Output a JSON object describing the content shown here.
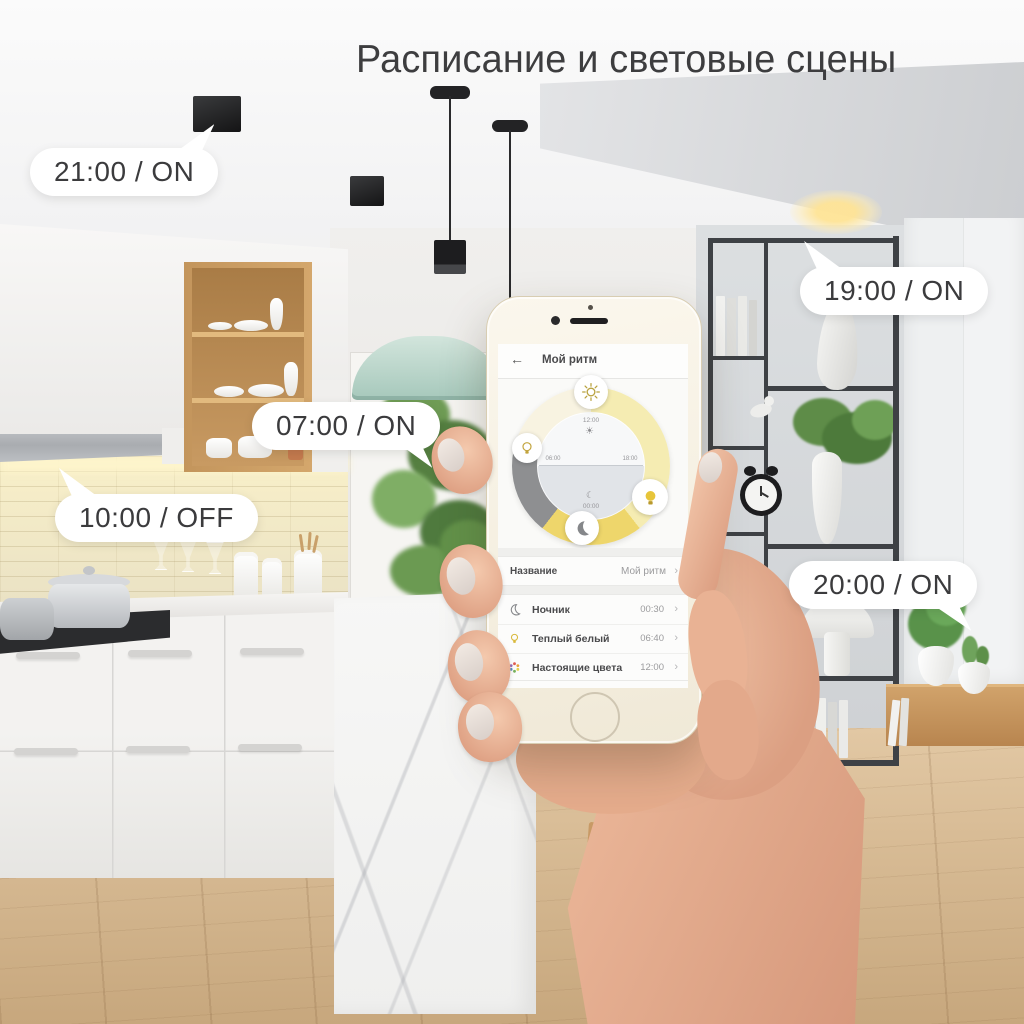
{
  "title": "Расписание и световые сцены",
  "callouts": {
    "c2100": "21:00 / ON",
    "c0700": "07:00 / ON",
    "c1000": "10:00 / OFF",
    "c1900": "19:00 / ON",
    "c2000": "20:00 / ON"
  },
  "phone": {
    "app": {
      "header": {
        "back": "←",
        "title": "Мой ритм"
      },
      "dial": {
        "top_time": "12:00",
        "left_time": "06:00",
        "right_time": "18:00",
        "bottom_time": "00:00",
        "sun_glyph": "☀",
        "moon_glyph": "☾",
        "segments": {
          "day": "#f5ecb2",
          "evening": "#eed66b",
          "night": "#8e8f91",
          "morning": "#f8f3e1"
        }
      },
      "name_row": {
        "label": "Название",
        "value": "Мой ритм",
        "chevron": "›"
      },
      "scenes": [
        {
          "icon": "moon-icon",
          "label": "Ночник",
          "time": "00:30",
          "chevron": "›"
        },
        {
          "icon": "bulb-icon",
          "label": "Теплый белый",
          "time": "06:40",
          "chevron": "›"
        },
        {
          "icon": "palette-icon",
          "label": "Настоящие цвета",
          "time": "12:00",
          "chevron": "›"
        }
      ]
    }
  },
  "colors": {
    "bubble_bg": "#ffffff",
    "bubble_text": "#3b3b3d",
    "accent_yellow": "#e7c53a"
  }
}
